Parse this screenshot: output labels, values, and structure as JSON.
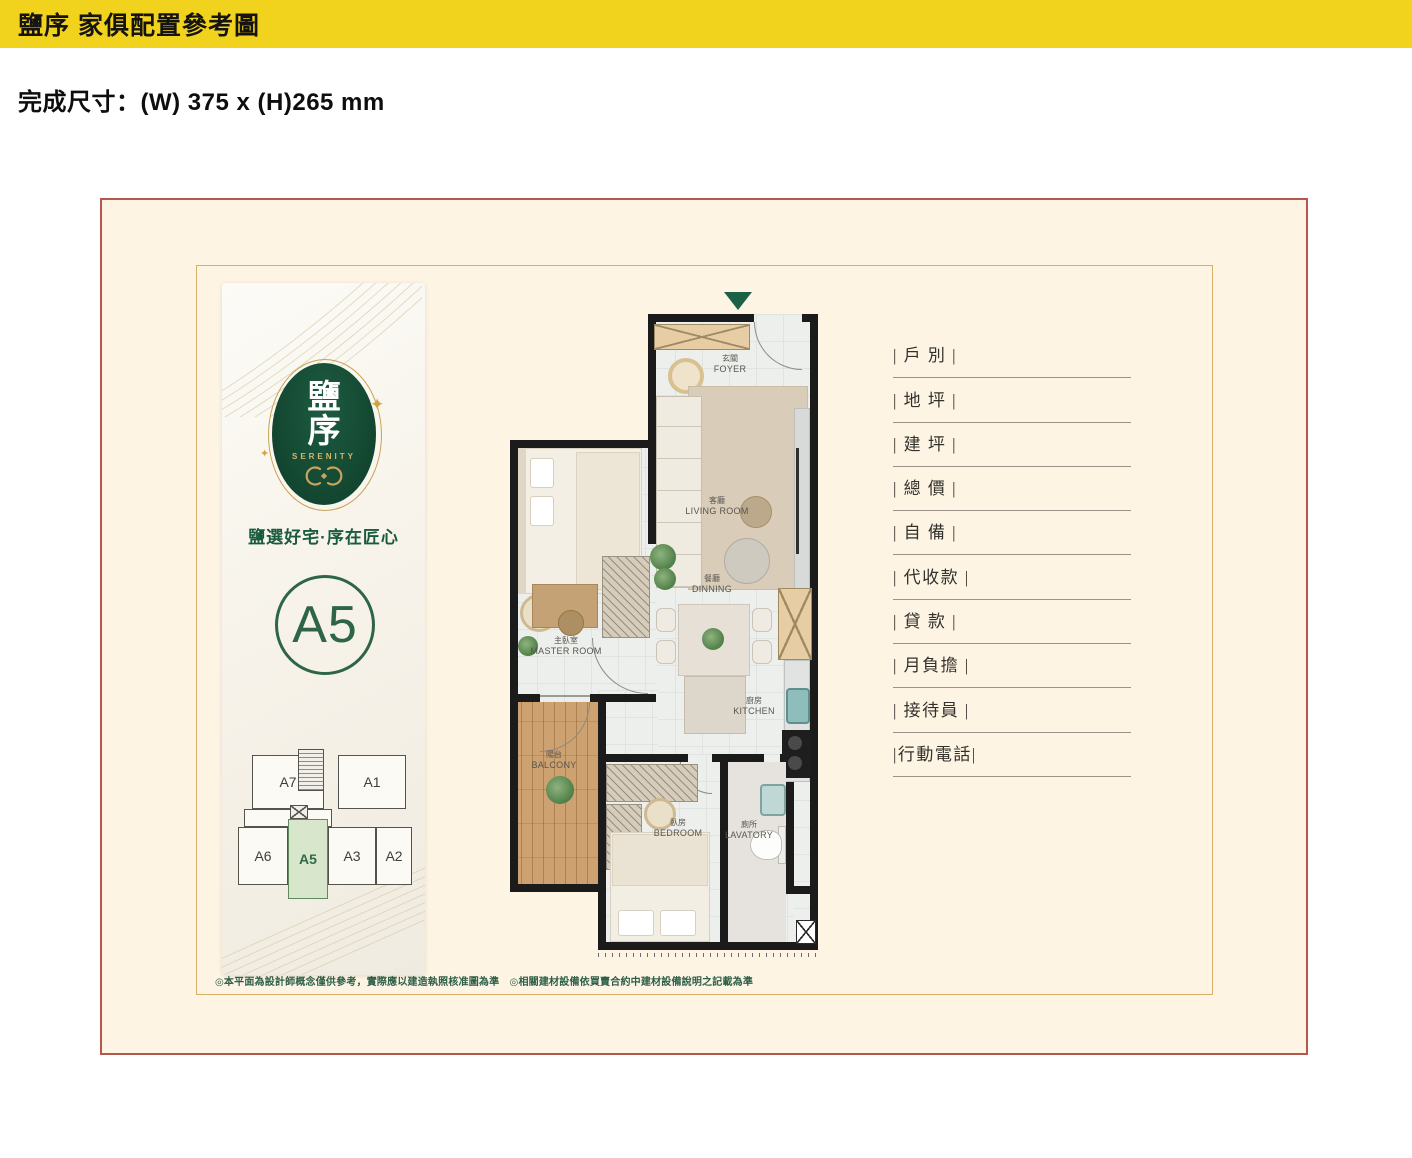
{
  "banner": {
    "title": "鹽序 家俱配置參考圖"
  },
  "subtitle": "完成尺寸：(W) 375 x (H)265 mm",
  "colors": {
    "banner_yellow": "#F1D31E",
    "frame_red": "#B4574D",
    "frame_gold": "#D7AF67",
    "paper_cream": "#FDF4E3",
    "brand_green": "#17503A",
    "brand_gold": "#C9A45C",
    "keyplan_highlight": "#D8E6CB"
  },
  "brand": {
    "logo_char_top": "鹽",
    "logo_char_bottom": "序",
    "logo_en": "SERENITY",
    "tagline": "鹽選好宅·序在匠心",
    "unit_label": "A5",
    "sparkle": "✦"
  },
  "keyplan": {
    "units": [
      {
        "label": "A7",
        "highlight": false
      },
      {
        "label": "A1",
        "highlight": false
      },
      {
        "label": "A6",
        "highlight": false
      },
      {
        "label": "A5",
        "highlight": true
      },
      {
        "label": "A3",
        "highlight": false
      },
      {
        "label": "A2",
        "highlight": false
      }
    ]
  },
  "plan": {
    "rooms": [
      {
        "zh": "玄關",
        "en": "FOYER"
      },
      {
        "zh": "客廳",
        "en": "LIVING ROOM"
      },
      {
        "zh": "餐廳",
        "en": "DINNING"
      },
      {
        "zh": "廚房",
        "en": "KITCHEN"
      },
      {
        "zh": "主臥室",
        "en": "MASTER ROOM"
      },
      {
        "zh": "陽台",
        "en": "BALCONY"
      },
      {
        "zh": "臥房",
        "en": "BEDROOM"
      },
      {
        "zh": "廁所",
        "en": "LAVATORY"
      }
    ]
  },
  "fields": {
    "items": [
      "| 戶 別 |",
      "| 地 坪 |",
      "| 建 坪 |",
      "| 總 價 |",
      "| 自 備 |",
      "| 代收款 |",
      "| 貸 款 |",
      "| 月負擔 |",
      "| 接待員 |",
      "|行動電話|"
    ]
  },
  "note": "◎本平面為設計師概念僅供參考，實際應以建造執照核准圖為準　◎相關建材設備依買賣合約中建材設備說明之記載為準"
}
